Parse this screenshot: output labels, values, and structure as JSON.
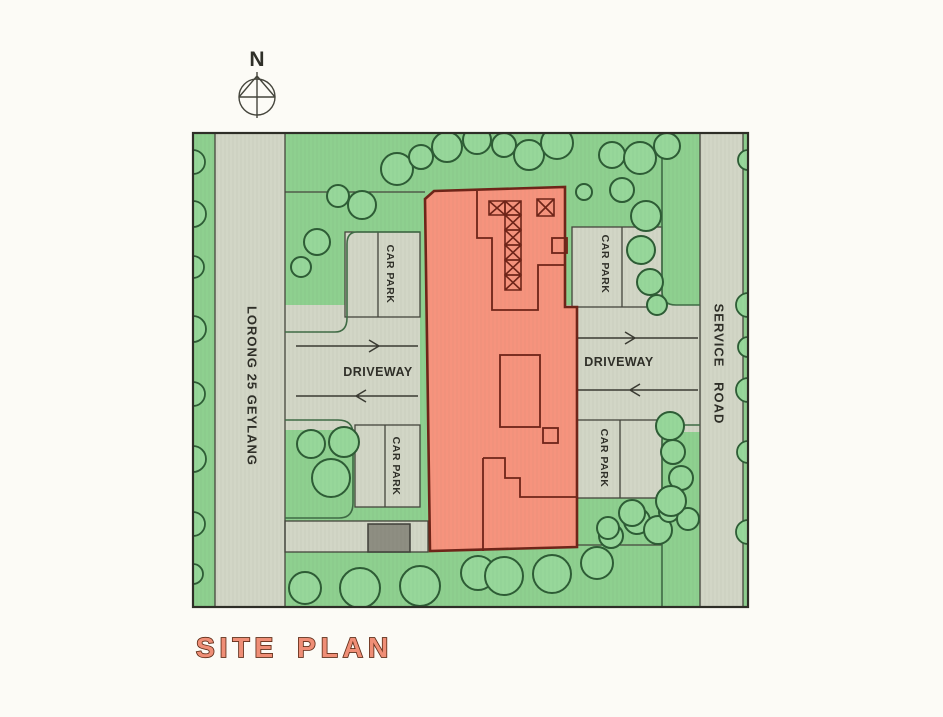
{
  "compass": {
    "north_label": "N"
  },
  "map": {
    "left_road_label": "LORONG 25 GEYLANG",
    "service_road_label": "SERVICE ROAD",
    "driveway_left_label": "DRIVEWAY",
    "driveway_right_label": "DRIVEWAY",
    "car_park_top_left_label": "CAR PARK",
    "car_park_top_right_label": "CAR PARK",
    "car_park_bottom_left_label": "CAR PARK",
    "car_park_bottom_right_label": "CAR PARK",
    "colors": {
      "vegetation_green": "#8ed08f",
      "tree_fill": "#97d79a",
      "tree_outline": "#2d5c35",
      "paving_gray": "#d2d6c6",
      "building_fill": "#f6937d",
      "building_outline": "#6f2418",
      "substation_gray": "#8e8e82",
      "title_fill": "#ef8e76",
      "title_outline": "#5f2c17"
    }
  },
  "title": {
    "label": "SITE PLAN"
  }
}
